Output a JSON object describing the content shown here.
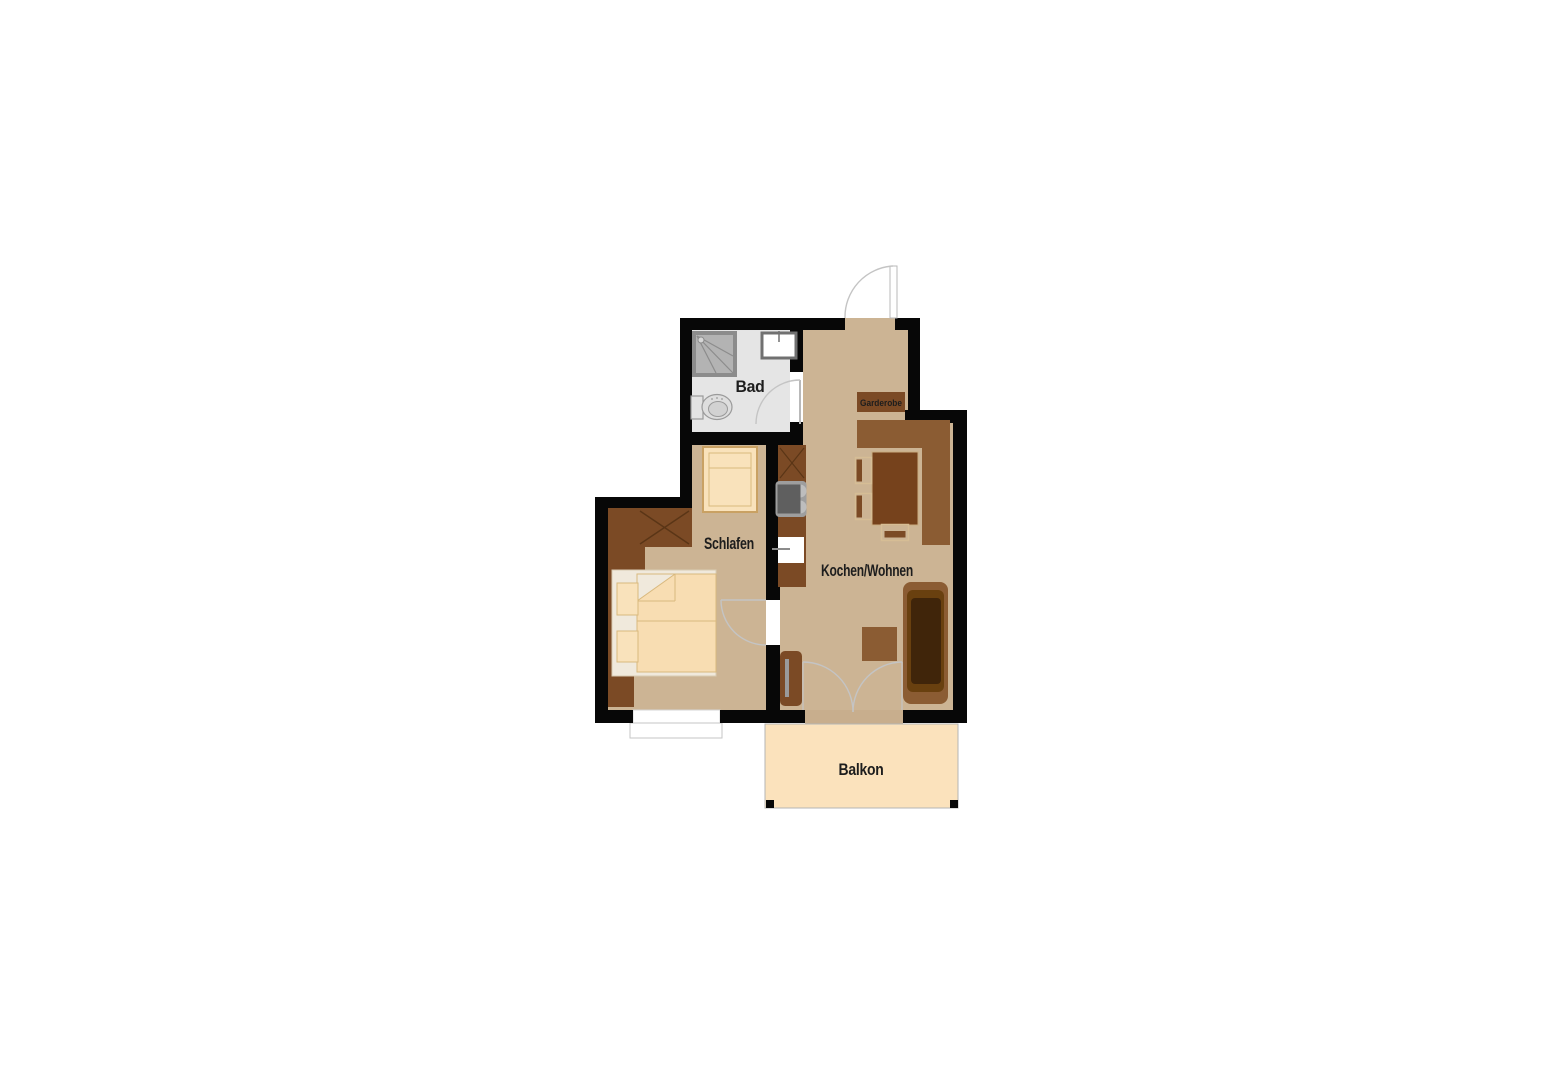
{
  "floorplan": {
    "rooms": {
      "bad": "Bad",
      "schlafen": "Schlafen",
      "kochen_wohnen": "Kochen/Wohnen",
      "garderobe": "Garderobe",
      "balkon": "Balkon"
    },
    "colors": {
      "wall": "#070707",
      "floor": "#ccb494",
      "bath": "#e5e5e5",
      "balcony": "#fbe2bc",
      "sill": "#c8ae8d",
      "furnDark": "#7b4a25",
      "furnMid": "#8b5c33",
      "furnLine": "#5a3516",
      "table": "#76421c",
      "tableEdge": "#c9ab80",
      "chairLine": "#d6bd95",
      "sofaSeat": "#69400f",
      "sofaCore": "#40250a",
      "bedFrame": "#f0e9dc",
      "bedFrameEdge": "#d8cbb2",
      "mattress": "#f8ddb2",
      "bedLine": "#d9b97e",
      "cream": "#f9e2bb",
      "creamBorder": "#c9a163",
      "fixFill": "#b3b3b3",
      "fixStroke": "#8c8c8c",
      "fixDark": "#5f5f5f",
      "stoveBase": "#9e9e9e",
      "burner": "#bdbdbd",
      "toiletFill": "#dedede",
      "toiletStroke": "#9a9a9a",
      "tv": "#9a9a9a",
      "arc": "#c4c4c4",
      "outline": "#b5b5b5",
      "label": "#1d1d1d"
    }
  }
}
